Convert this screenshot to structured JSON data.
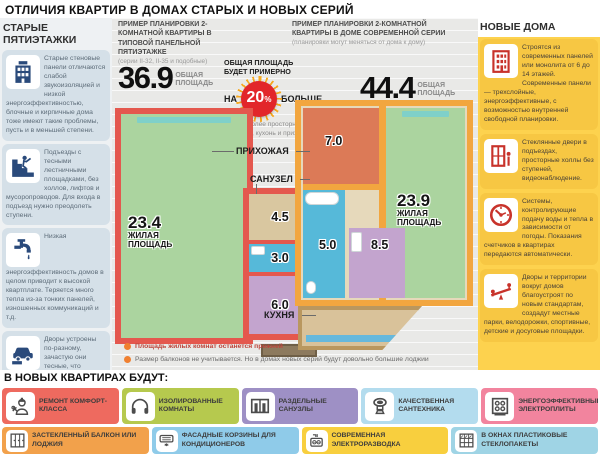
{
  "title": "ОТЛИЧИЯ КВАРТИР В ДОМАХ СТАРЫХ И НОВЫХ СЕРИЙ",
  "palette": {
    "old_wall": "#e4584e",
    "new_wall": "#f2a63f",
    "living": "#abd49f",
    "hallway_old": "#d9c7a0",
    "hallway_new": "#dc7a57",
    "bathroom": "#56b9d9",
    "kitchen": "#c3a4ce",
    "badge_red": "#e2262a",
    "left_icon": "#2a4a7b",
    "right_icon": "#c8332b"
  },
  "left_column": {
    "header": "СТАРЫЕ ПЯТИЭТАЖКИ",
    "items": [
      {
        "icon": "old-panel-building-icon",
        "text": "Старые стеновые панели отличаются слабой звукоизоляцией и низкой энергоэффективностью, блочные и кирпичные дома тоже имеют такие проблемы, пусть и в меньшей степени."
      },
      {
        "icon": "stairs-person-icon",
        "text": "Подъезды с тесными лестничными площадками, без холлов, лифтов и мусоропроводов. Для входа в подъезд нужно преодолеть ступени."
      },
      {
        "icon": "faucet-icon",
        "text": "Низкая энергоэффективность домов в целом приводит к высокой квартплате. Теряется много тепла из-за тонких панелей, изношенных коммуникаций и т.д."
      },
      {
        "icon": "car-parking-icon",
        "text": "Дворы устроены по-разному, зачастую они тесные, что приводит к дефициту парковочных мест и свободного пространства."
      }
    ]
  },
  "right_column": {
    "header": "НОВЫЕ ДОМА",
    "items": [
      {
        "icon": "modern-building-icon",
        "text": "Строятся из современных панелей или монолита от 6 до 14 этажей. Современные панели — трехслойные, энергоэффективные, с возможностью внутренней свободной планировки."
      },
      {
        "icon": "entrance-door-icon",
        "text": "Стеклянные двери в подъездах, просторные холлы без ступеней, видеонаблюдение."
      },
      {
        "icon": "meter-gauge-icon",
        "text": "Системы, контролирующие подачу воды и тепла в зависимости от погоды. Показания счетчиков в квартирах передаются автоматически."
      },
      {
        "icon": "playground-seesaw-icon",
        "text": "Дворы и территории вокруг домов благоустроят по новым стандартам, создадут местные парки, велодорожки, спортивные, детские и досуговые площадки."
      }
    ]
  },
  "center": {
    "old_plan": {
      "header": "ПРИМЕР ПЛАНИРОВКИ 2-КОМНАТНОЙ КВАРТИРЫ В ТИПОВОЙ ПАНЕЛЬНОЙ ПЯТИЭТАЖКЕ",
      "subheader": "(серии II-32, II-35 и подобные)",
      "total_area": "36.9",
      "total_area_label": "ОБЩАЯ ПЛОЩАДЬ",
      "rooms": {
        "living": {
          "value": "23.4",
          "label": "ЖИЛАЯ ПЛОЩАДЬ"
        },
        "hallway": {
          "value": "4.5"
        },
        "bathroom": {
          "value": "3.0"
        },
        "kitchen": {
          "value": "6.0"
        }
      }
    },
    "new_plan": {
      "header": "ПРИМЕР ПЛАНИРОВКИ 2-КОМНАТНОЙ КВАРТИРЫ В ДОМЕ СОВРЕМЕННОЙ СЕРИИ",
      "subheader": "(планировки могут меняться от дома к дому)",
      "total_area": "44.4",
      "total_area_label": "ОБЩАЯ ПЛОЩАДЬ",
      "rooms": {
        "living": {
          "value": "23.9",
          "label": "ЖИЛАЯ ПЛОЩАДЬ"
        },
        "hallway": {
          "value": "7.0"
        },
        "bathroom": {
          "value": "5.0"
        },
        "kitchen": {
          "value": "8.5"
        }
      }
    },
    "badge": {
      "title": "ОБЩАЯ ПЛОЩАДЬ БУДЕТ ПРИМЕРНО",
      "na": "НА",
      "value": "20",
      "percent": "%",
      "bigger": "БОЛЬШЕ",
      "note": "за счет более просторных санузлов, кухонь и прихожих"
    },
    "room_labels": {
      "hallway": "ПРИХОЖАЯ",
      "bathroom": "САНУЗЕЛ",
      "kitchen": "КУХНЯ"
    },
    "footnotes": [
      "Площадь жилых комнат останется прежней",
      "Размер балконов не учитывается. Но в домах новых серий будут довольно большие лоджии"
    ]
  },
  "bottom": {
    "header": "В НОВЫХ КВАРТИРАХ БУДУТ:",
    "row1": [
      {
        "label": "РЕМОНТ КОМФОРТ-КЛАССА",
        "color": "#ee6a5f",
        "icon": "worker-icon"
      },
      {
        "label": "ИЗОЛИРОВАННЫЕ КОМНАТЫ",
        "color": "#b6c94e",
        "icon": "headphones-icon"
      },
      {
        "label": "РАЗДЕЛЬНЫЕ САНУЗЛЫ",
        "color": "#9e90c5",
        "icon": "separate-bathroom-icon"
      },
      {
        "label": "КАЧЕСТВЕННАЯ САНТЕХНИКА",
        "color": "#b3dcee",
        "icon": "toilet-icon"
      },
      {
        "label": "ЭНЕРГОЭФФЕКТИВНЫЕ ЭЛЕКТРОПЛИТЫ",
        "color": "#f2849e",
        "icon": "stove-icon"
      }
    ],
    "row2": [
      {
        "label": "ЗАСТЕКЛЕННЫЙ БАЛКОН ИЛИ ЛОДЖИЯ",
        "color": "#f2a14b",
        "icon": "glazed-balcony-icon"
      },
      {
        "label": "ФАСАДНЫЕ КОРЗИНЫ ДЛЯ КОНДИЦИОНЕРОВ",
        "color": "#8fcbe9",
        "icon": "air-conditioner-icon"
      },
      {
        "label": "СОВРЕМЕННАЯ ЭЛЕКТРОРАЗВОДКА",
        "color": "#f8cf3e",
        "icon": "outlet-icon"
      },
      {
        "label": "В ОКНАХ ПЛАСТИКОВЫЕ СТЕКЛОПАКЕТЫ",
        "color": "#9fd4e5",
        "icon": "window-panes-icon"
      }
    ]
  }
}
